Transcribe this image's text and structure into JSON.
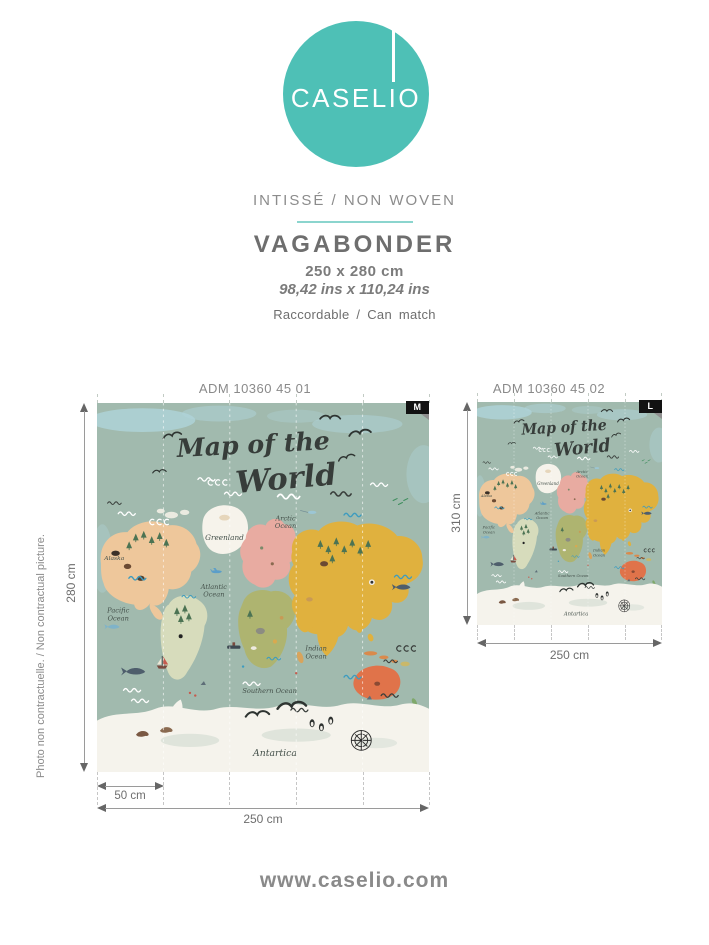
{
  "brand": {
    "name": "CASELIO",
    "website": "www.caselio.com"
  },
  "header": {
    "material": "INTISSÉ / NON WOVEN",
    "product_name": "VAGABONDER",
    "size_cm": "250 x 280 cm",
    "size_inches": "98,42 ins x 110,24 ins",
    "match_note": "Raccordable / Can match"
  },
  "disclaimer": "Photo non contractuelle. / Non contractual picture.",
  "variants": [
    {
      "reference": "ADM 10360 45 01",
      "size_badge": "M",
      "height": "280 cm",
      "width": "250 cm",
      "panel_width": "50 cm"
    },
    {
      "reference": "ADM 10360 45 02",
      "size_badge": "L",
      "height": "310 cm",
      "width": "250 cm"
    }
  ],
  "map_artwork": {
    "title_line1": "Map of the",
    "title_line2": "World",
    "labels": {
      "alaska": "Alaska",
      "greenland": "Greenland",
      "arctic": [
        "Arctic",
        "Ocean"
      ],
      "atlantic": [
        "Atlantic",
        "Ocean"
      ],
      "pacific": [
        "Pacific",
        "Ocean"
      ],
      "indian": [
        "Indian",
        "Ocean"
      ],
      "southern": "Southern Ocean",
      "antarctica": "Antartica"
    },
    "colors": {
      "sea": "#A1BAAE",
      "sky_wash": "#AFD4DA",
      "north_america": "#EEC79B",
      "greenland": "#F6F3EB",
      "europe": "#E8ABA1",
      "asia": "#E0B13E",
      "africa": "#AEB470",
      "south_america": "#D7DCBC",
      "australia": "#E0734A",
      "antarctica": "#F5F3EC"
    }
  },
  "theme": {
    "brand_teal": "#4EC0B6",
    "divider_teal": "#8BD5CE",
    "text_gray": "#8A8A8A",
    "dark_gray": "#6E6E6E",
    "badge_black": "#121212"
  }
}
